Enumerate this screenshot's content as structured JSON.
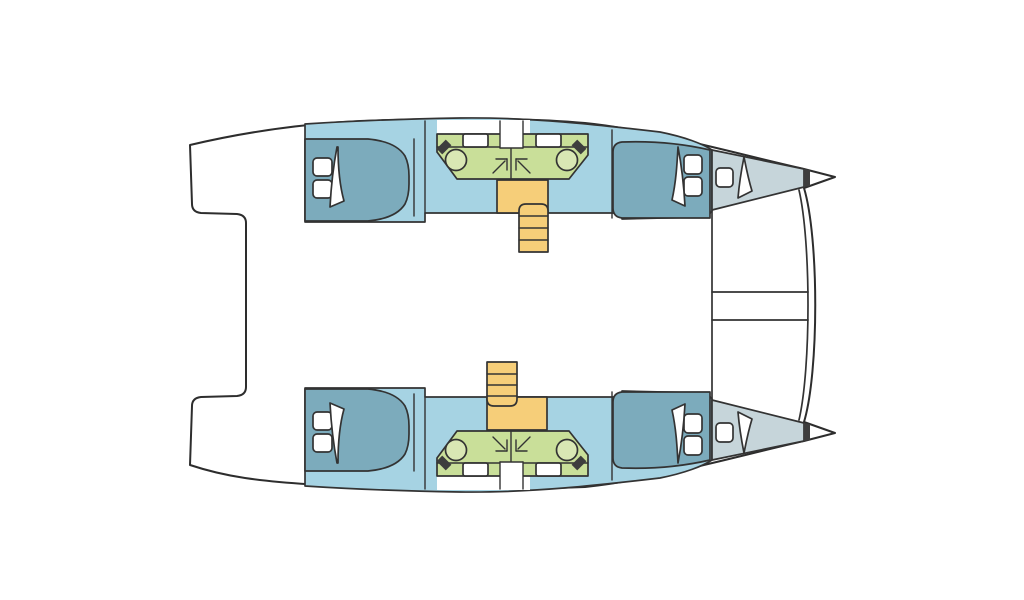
{
  "page": {
    "background": "#ffffff"
  },
  "colors": {
    "outline": "#333333",
    "white": "#ffffff",
    "hull_interior": "#a6d3e3",
    "bed": "#7cabbc",
    "bathroom": "#c9df99",
    "sink": "#d9e7b4",
    "stairs": "#f6ce79",
    "forepeak": "#c6d5da",
    "bow_bulkhead": "#3d3d3d"
  },
  "diagram": {
    "type": "boat-floor-plan",
    "vessel": "catamaran",
    "orientation": "bow-right",
    "hulls": [
      {
        "name": "upper-hull",
        "rooms": [
          "aft-double-cabin",
          "aft-bathroom",
          "forward-bathroom",
          "forward-double-cabin",
          "forepeak"
        ],
        "features": [
          "double-berth-with-two-pillows",
          "duvet-fold",
          "sink-with-faucet",
          "toilet",
          "shower-arrow-symbol",
          "deck-hatch",
          "companionway-stairs-with-landing"
        ]
      },
      {
        "name": "lower-hull",
        "rooms": [
          "aft-double-cabin",
          "aft-bathroom",
          "forward-bathroom",
          "forward-double-cabin",
          "forepeak"
        ],
        "features": [
          "double-berth-with-two-pillows",
          "duvet-fold",
          "sink-with-faucet",
          "toilet",
          "shower-arrow-symbol",
          "deck-hatch",
          "companionway-stairs-with-landing"
        ]
      }
    ],
    "center_elements": [
      "aft-cockpit-notch",
      "bridgedeck-saloon",
      "bridgedeck-front-beam",
      "foredeck-crossbeam",
      "trampoline-edge-curves",
      "bow-points"
    ]
  }
}
